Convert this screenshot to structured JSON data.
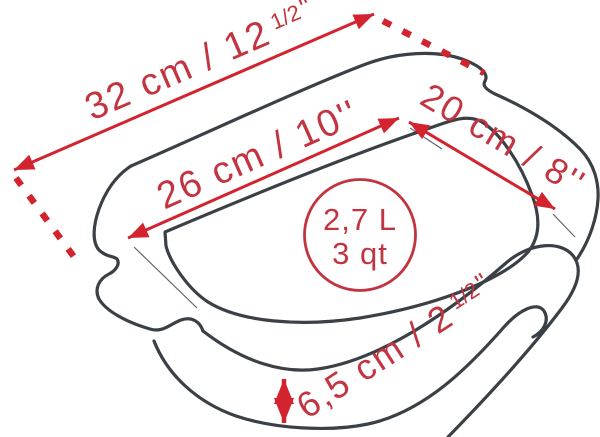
{
  "diagram": {
    "subject": "rectangular baking dish with side handles, perspective line drawing",
    "style": "technical dimension diagram"
  },
  "dimensions": {
    "outer_length": {
      "text_main": "32 cm / 12",
      "sup": "1/2",
      "unit_marks": "''"
    },
    "inner_length": {
      "label": "26 cm / 10''"
    },
    "inner_width": {
      "label": "20 cm / 8''"
    },
    "height": {
      "text_main": "6,5 cm / 2",
      "sup": "1/2",
      "unit_marks": "''"
    }
  },
  "capacity": {
    "liters": "2,7 L",
    "quarts": "3 qt"
  },
  "colors": {
    "outline": "#3a4045",
    "dimension_red": "#d2232e",
    "label_red": "#c23440",
    "background": "#ffffff"
  }
}
